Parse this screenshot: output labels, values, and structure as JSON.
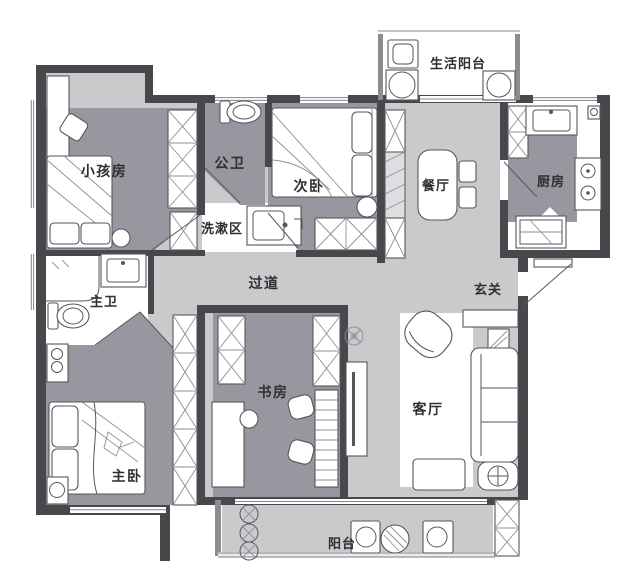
{
  "floorplan": {
    "type": "apartment-floor-plan",
    "colors": {
      "wall": "#47474c",
      "room_floor": "#97979f",
      "open_floor": "#cacacc",
      "background": "#ffffff",
      "label_text": "#2e2e33"
    },
    "rooms": [
      {
        "id": "life-balcony",
        "label": "生活阳台"
      },
      {
        "id": "kids-room",
        "label": "小孩房"
      },
      {
        "id": "public-bath",
        "label": "公卫"
      },
      {
        "id": "second-bedroom",
        "label": "次卧"
      },
      {
        "id": "dining",
        "label": "餐厅"
      },
      {
        "id": "kitchen",
        "label": "厨房"
      },
      {
        "id": "wash-area",
        "label": "洗漱区"
      },
      {
        "id": "corridor",
        "label": "过道"
      },
      {
        "id": "entry",
        "label": "玄关"
      },
      {
        "id": "master-bath",
        "label": "主卫"
      },
      {
        "id": "study",
        "label": "书房"
      },
      {
        "id": "living-room",
        "label": "客厅"
      },
      {
        "id": "master-bedroom",
        "label": "主卧"
      },
      {
        "id": "balcony",
        "label": "阳台"
      }
    ]
  }
}
